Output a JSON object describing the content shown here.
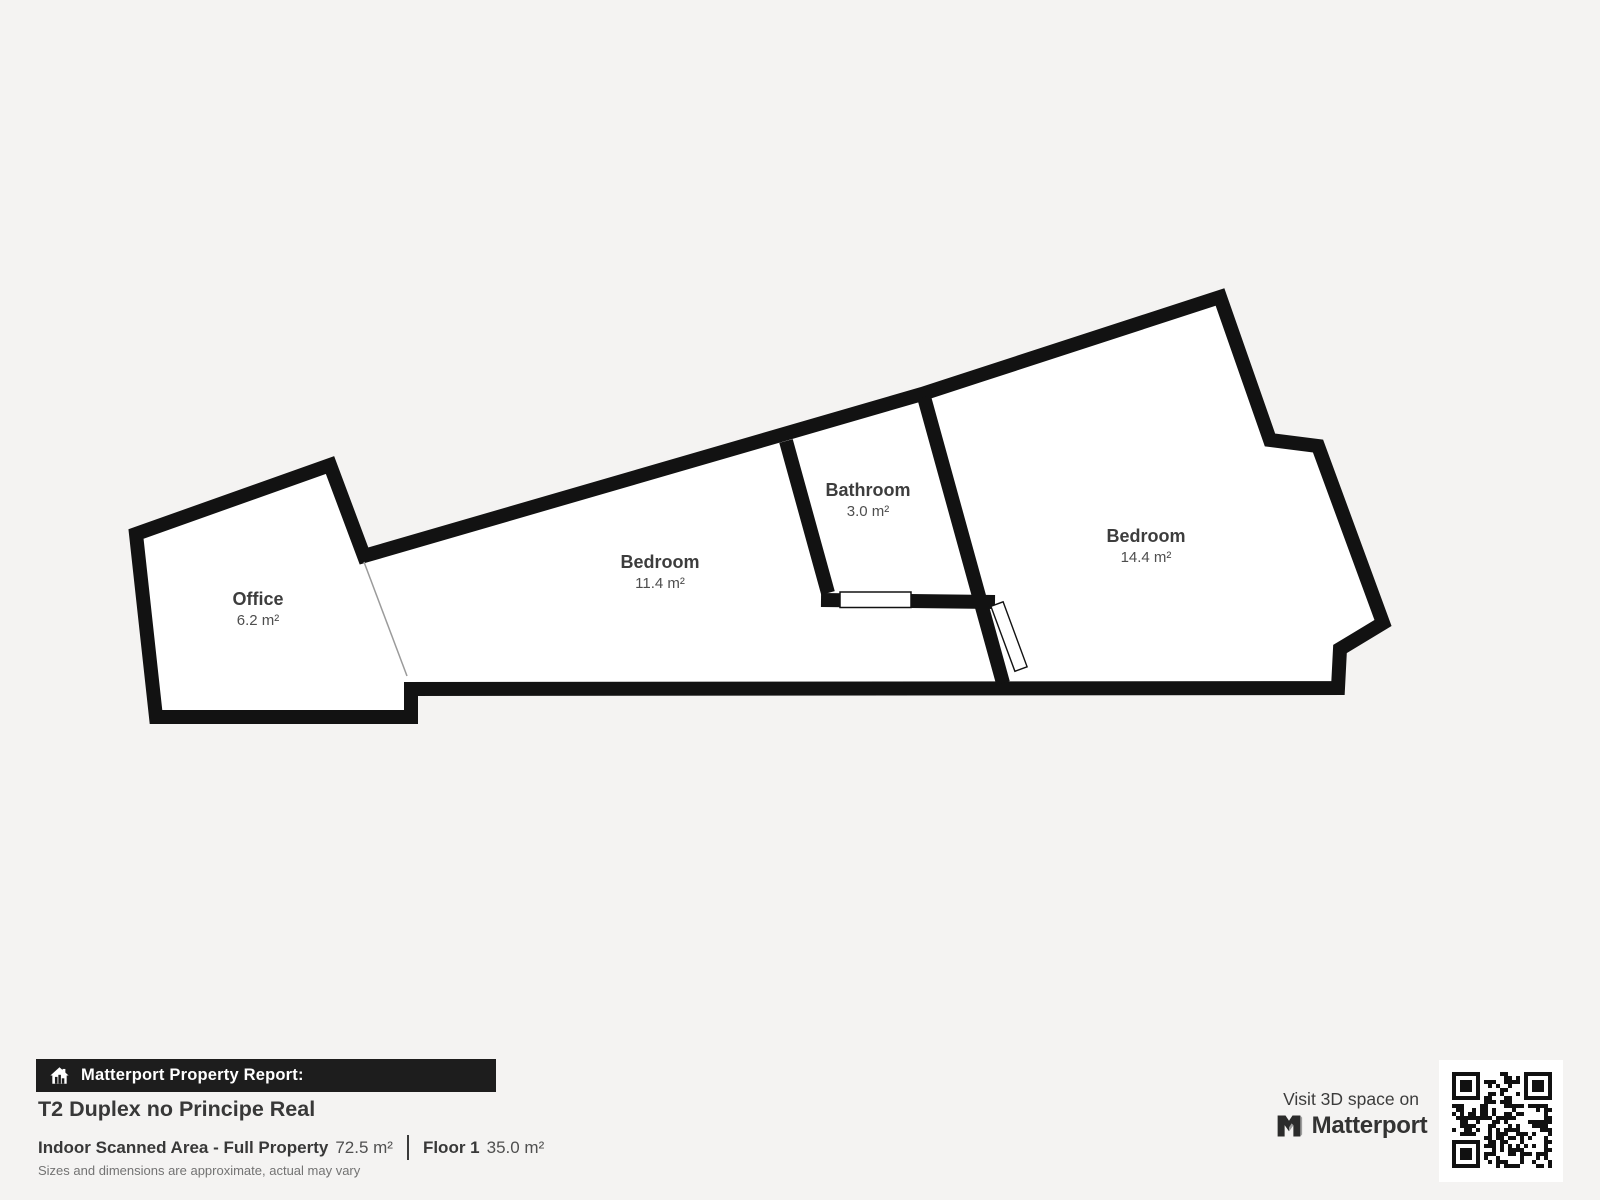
{
  "floorplan": {
    "rooms": [
      {
        "id": "office",
        "name": "Office",
        "area": "6.2 m²"
      },
      {
        "id": "bedroom-1",
        "name": "Bedroom",
        "area": "11.4 m²"
      },
      {
        "id": "bathroom",
        "name": "Bathroom",
        "area": "3.0 m²"
      },
      {
        "id": "bedroom-2",
        "name": "Bedroom",
        "area": "14.4 m²"
      }
    ]
  },
  "report": {
    "bar_label": "Matterport Property Report:",
    "title": "T2 Duplex no Principe Real",
    "stats": {
      "scanned_label": "Indoor Scanned Area - Full Property",
      "scanned_value": "72.5 m²",
      "floor_label": "Floor 1",
      "floor_value": "35.0 m²"
    },
    "disclaimer": "Sizes and dimensions are approximate, actual may vary"
  },
  "promo": {
    "visit_label": "Visit 3D space on",
    "brand": "Matterport"
  },
  "colors": {
    "background": "#f4f3f2",
    "wall": "#121212",
    "floor": "#ffffff",
    "bar_background": "#1d1d1d",
    "text_dark": "#3d3d3d",
    "text_gray": "#737373"
  }
}
